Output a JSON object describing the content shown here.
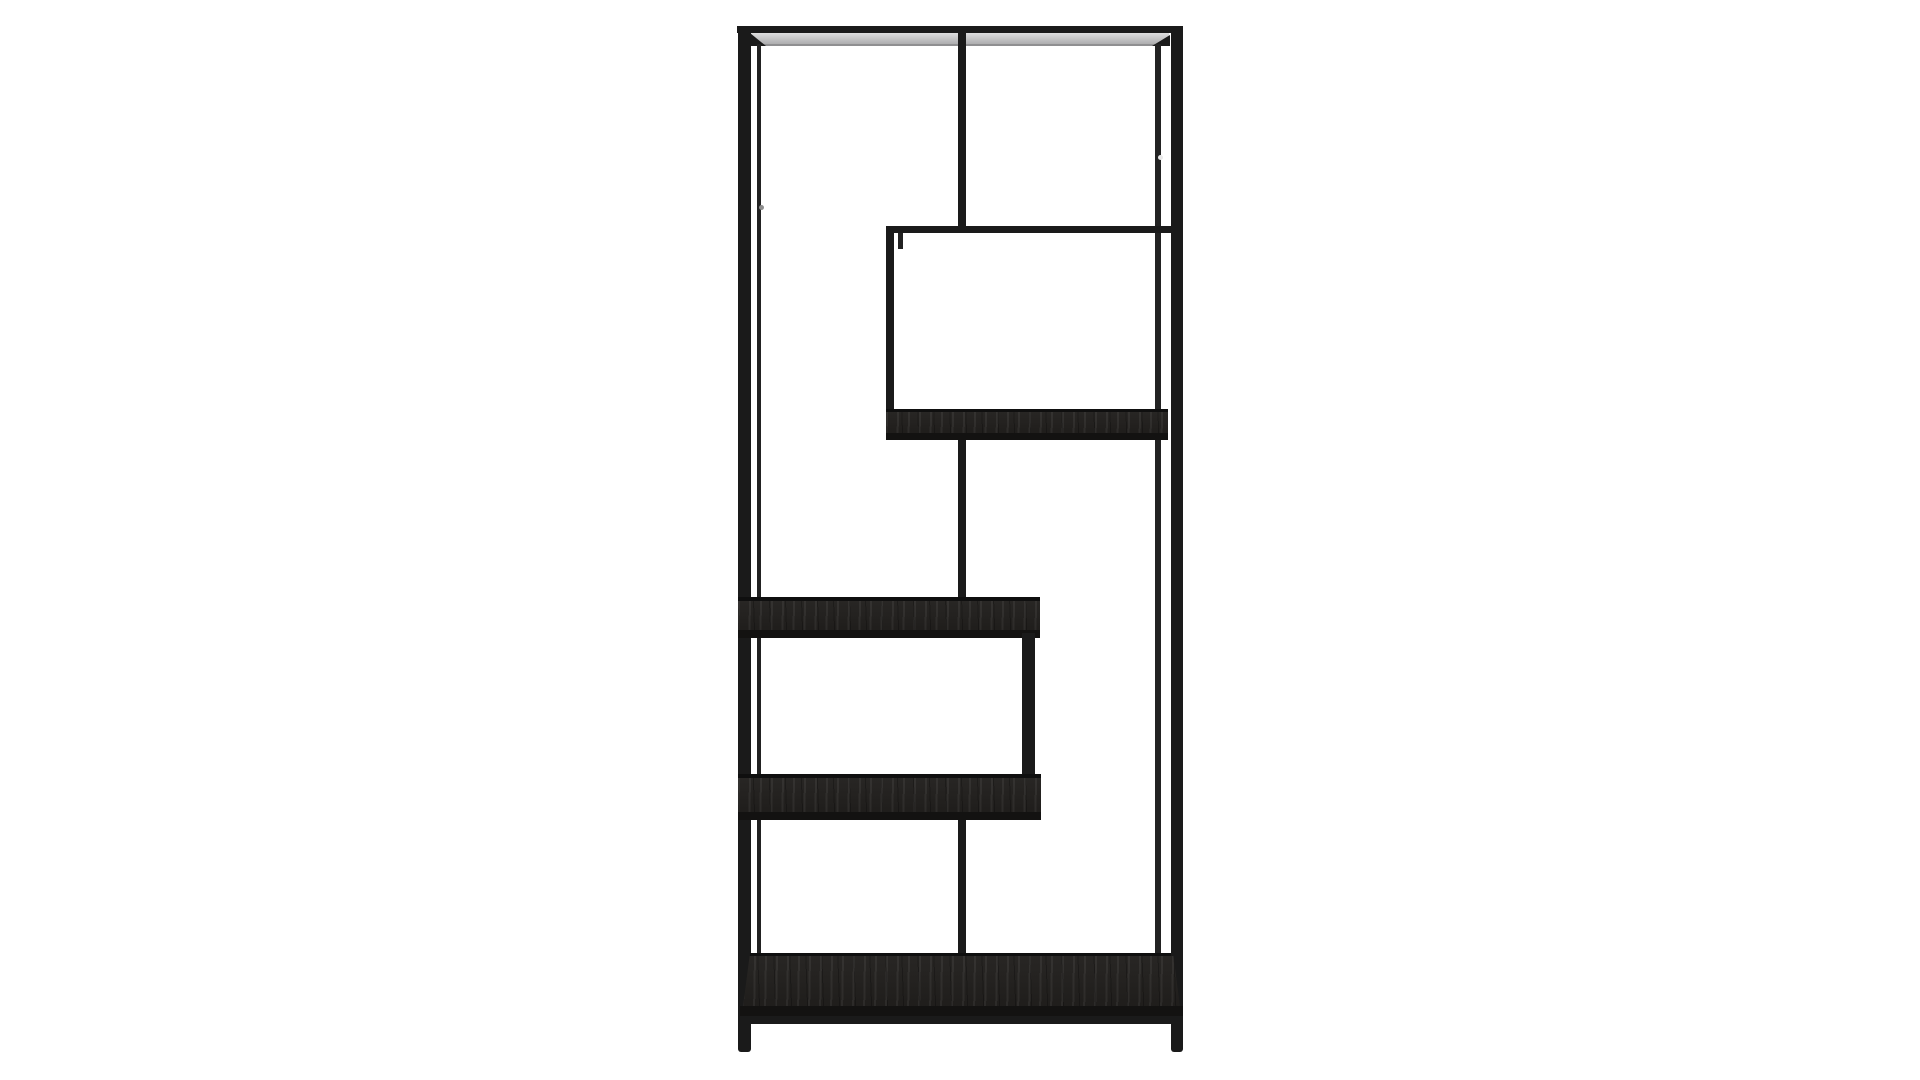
{
  "meta": {
    "description": "Cut-out product photograph of a tall black metal asymmetric etagere bookshelf with staggered dark wood shelves, centered on a plain white background",
    "background": "#ffffff"
  },
  "palette": {
    "frame": "#1a1a1a",
    "frameThin": "#222222",
    "frameDark": "#0f0f0f",
    "wood": "#211f1d",
    "woodEdge": "#131211",
    "undersideShadow": "#8f8f91",
    "dotGray": "#8d8d8d",
    "dotLight": "#e8e8e8"
  },
  "furniture": {
    "name": "asymmetric-etagere-bookshelf",
    "parts": [
      {
        "name": "top-rail",
        "x": 737,
        "y": 26,
        "w": 446,
        "h": 7,
        "color": "frame"
      },
      {
        "name": "top-shelf-underside",
        "x": 750,
        "y": 33,
        "w": 419,
        "h": 12,
        "color": "#c6c6c7",
        "cls": "metal-sheen"
      },
      {
        "name": "top-shelf-underside-shadow",
        "x": 750,
        "y": 44,
        "w": 419,
        "h": 2,
        "color": "undersideShadow"
      },
      {
        "name": "top-corner-brace-left",
        "x": 750,
        "y": 33,
        "w": 16,
        "h": 13,
        "color": "frame",
        "clip": "polygon(0 0, 100% 100%, 0 100%)"
      },
      {
        "name": "top-corner-brace-right",
        "x": 1152,
        "y": 35,
        "w": 18,
        "h": 11,
        "color": "frame",
        "clip": "polygon(100% 0, 100% 100%, 0 100%)"
      },
      {
        "name": "left-post",
        "x": 738,
        "y": 26,
        "w": 13,
        "h": 1026,
        "color": "frame",
        "cls": "round-foot"
      },
      {
        "name": "left-back-post",
        "x": 757,
        "y": 44,
        "w": 4,
        "h": 912,
        "color": "frameThin"
      },
      {
        "name": "right-post",
        "x": 1171,
        "y": 26,
        "w": 12,
        "h": 1026,
        "color": "frame",
        "cls": "round-foot"
      },
      {
        "name": "right-front-post",
        "x": 1155,
        "y": 44,
        "w": 6,
        "h": 912,
        "color": "frameThin"
      },
      {
        "name": "center-divider-upper",
        "x": 958,
        "y": 33,
        "w": 8,
        "h": 193,
        "color": "frame"
      },
      {
        "name": "upper-box-top-rail",
        "x": 886,
        "y": 226,
        "w": 297,
        "h": 7,
        "color": "frame"
      },
      {
        "name": "upper-box-left-edge",
        "x": 886,
        "y": 226,
        "w": 8,
        "h": 214,
        "color": "frame"
      },
      {
        "name": "upper-box-left-back-stub",
        "x": 898,
        "y": 233,
        "w": 5,
        "h": 16,
        "color": "frameThin"
      },
      {
        "name": "upper-box-shelf-back-line",
        "x": 886,
        "y": 409,
        "w": 282,
        "h": 3,
        "color": "frameDark"
      },
      {
        "name": "upper-box-shelf-surface",
        "x": 886,
        "y": 412,
        "w": 282,
        "h": 21,
        "color": "wood",
        "cls": "grain"
      },
      {
        "name": "upper-box-shelf-front-edge",
        "x": 886,
        "y": 433,
        "w": 282,
        "h": 7,
        "color": "woodEdge"
      },
      {
        "name": "center-divider-middle",
        "x": 958,
        "y": 440,
        "w": 8,
        "h": 161,
        "color": "frame"
      },
      {
        "name": "middle-shelf-back-line",
        "x": 738,
        "y": 597,
        "w": 302,
        "h": 4,
        "color": "frameDark"
      },
      {
        "name": "middle-shelf-surface",
        "x": 738,
        "y": 601,
        "w": 302,
        "h": 29,
        "color": "wood",
        "cls": "grain"
      },
      {
        "name": "middle-shelf-front-edge",
        "x": 738,
        "y": 630,
        "w": 302,
        "h": 8,
        "color": "woodEdge"
      },
      {
        "name": "lower-box-right-wall",
        "x": 1022,
        "y": 633,
        "w": 13,
        "h": 144,
        "color": "frame"
      },
      {
        "name": "lower-box-shelf-back-line",
        "x": 738,
        "y": 774,
        "w": 303,
        "h": 4,
        "color": "frameDark"
      },
      {
        "name": "lower-box-shelf-surface",
        "x": 738,
        "y": 778,
        "w": 303,
        "h": 34,
        "color": "wood",
        "cls": "grain"
      },
      {
        "name": "lower-box-shelf-front-edge",
        "x": 738,
        "y": 812,
        "w": 303,
        "h": 8,
        "color": "woodEdge"
      },
      {
        "name": "center-divider-lower",
        "x": 958,
        "y": 820,
        "w": 8,
        "h": 136,
        "color": "frame"
      },
      {
        "name": "bottom-shelf-back-line",
        "x": 750,
        "y": 953,
        "w": 421,
        "h": 3,
        "color": "frameDark"
      },
      {
        "name": "bottom-shelf-surface",
        "x": 743,
        "y": 956,
        "w": 437,
        "h": 50,
        "color": "wood",
        "cls": "grain",
        "clip": "polygon(1.5% 0, 98.5% 0, 100% 100%, 0 100%)"
      },
      {
        "name": "bottom-shelf-front-edge",
        "x": 740,
        "y": 1006,
        "w": 443,
        "h": 10,
        "color": "woodEdge"
      },
      {
        "name": "bottom-front-rail",
        "x": 738,
        "y": 1016,
        "w": 445,
        "h": 8,
        "color": "frame"
      },
      {
        "name": "left-post-screw-dot",
        "x": 759,
        "y": 205,
        "w": 5,
        "h": 5,
        "color": "dotGray",
        "cls": "dot"
      },
      {
        "name": "right-post-screw-dot",
        "x": 1158,
        "y": 155,
        "w": 5,
        "h": 5,
        "color": "dotLight",
        "cls": "dot"
      }
    ]
  }
}
